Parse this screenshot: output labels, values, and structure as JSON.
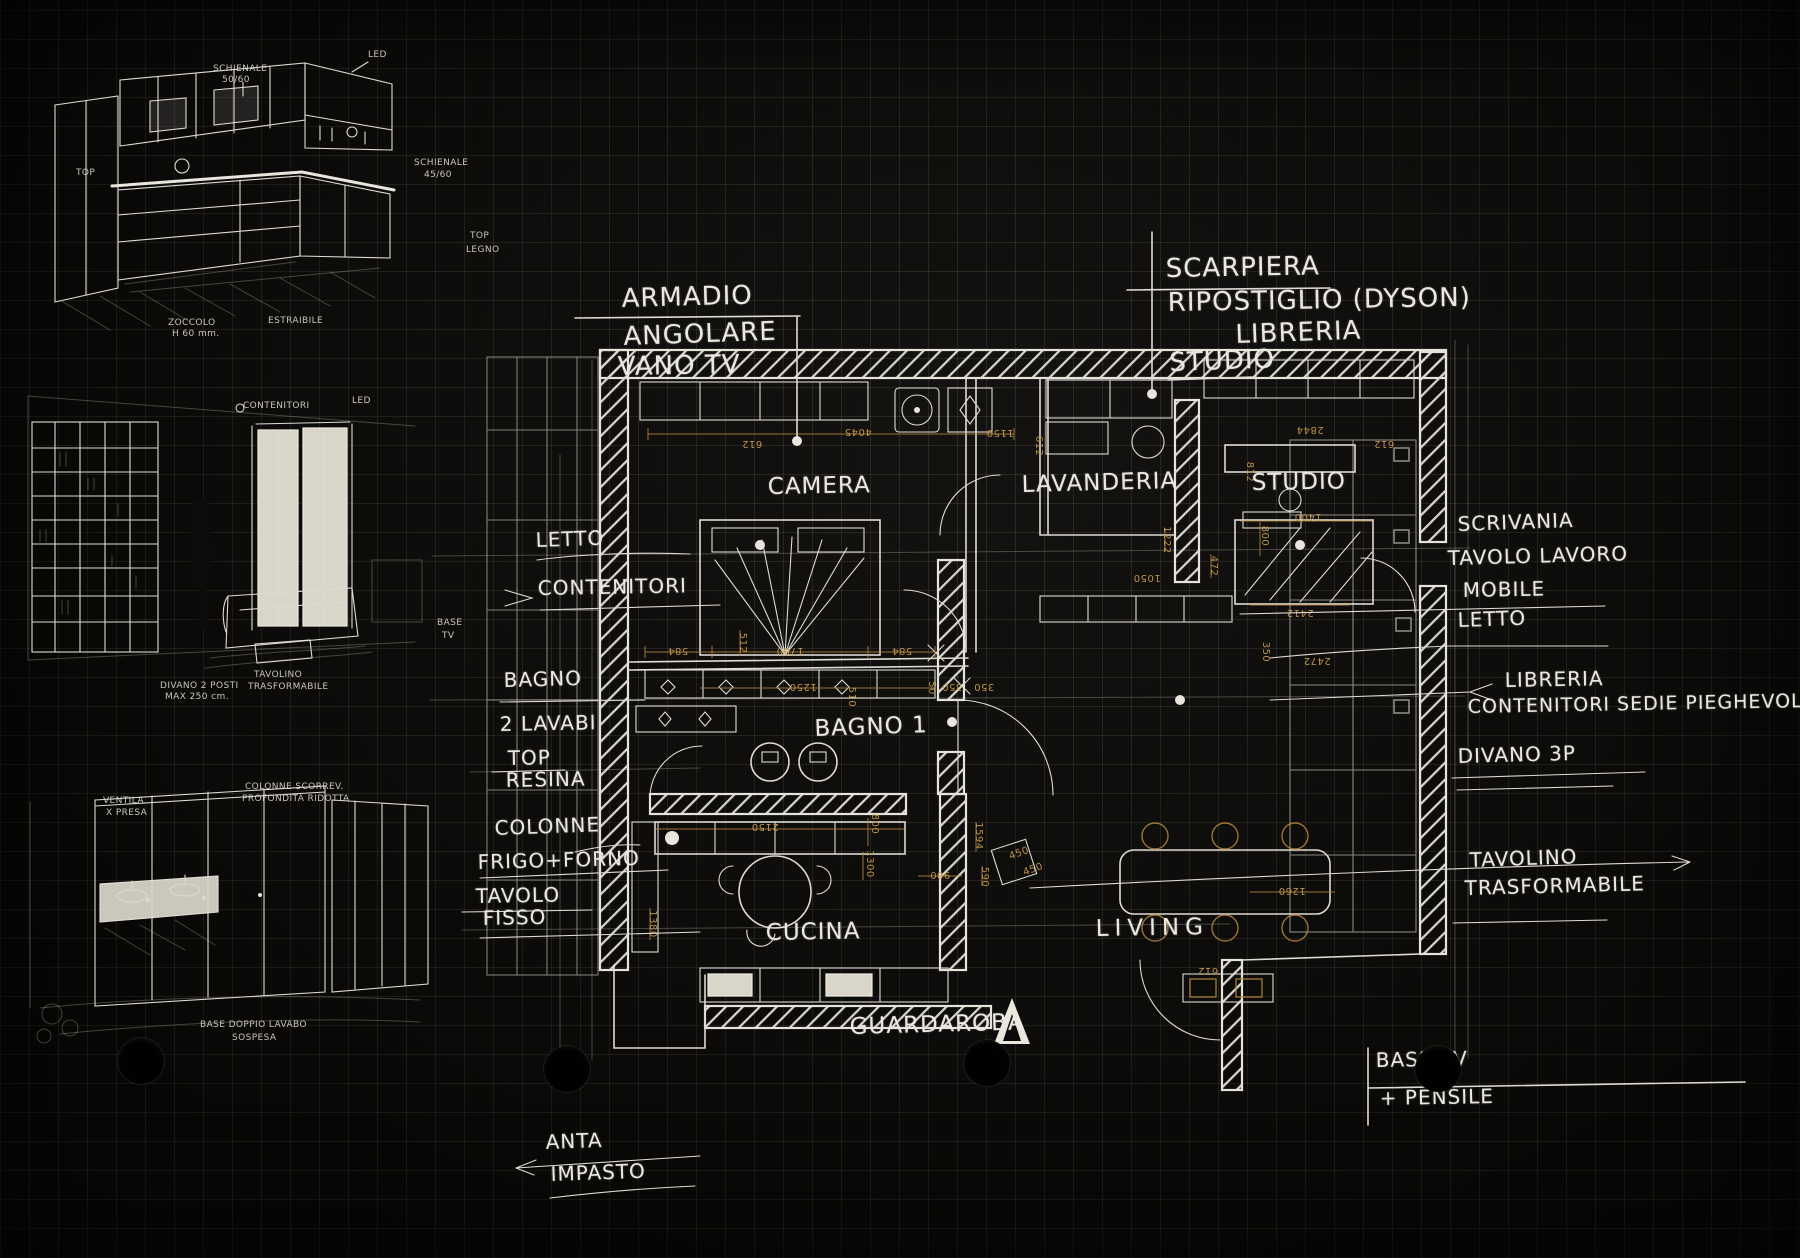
{
  "colors": {
    "paper": "#0b0a08",
    "grid": "#6e695f",
    "ink": "#eae8e0",
    "dimension": "#c2954a"
  },
  "callout_armadio": {
    "l1": "ARMADIO",
    "l2": "ANGOLARE",
    "l3": "VANO TV"
  },
  "callout_scarpiera": {
    "l1": "SCARPIERA",
    "l2": "RIPOSTIGLIO (DYSON)",
    "l3": "LIBRERIA",
    "l4": "STUDIO"
  },
  "rooms": {
    "camera": "CAMERA",
    "lavanderia": "LAVANDERIA",
    "studio": "STUDIO",
    "bagno1": "BAGNO 1",
    "cucina": "CUCINA",
    "living": "LIVING",
    "guardaroba": "GUARDAROBA"
  },
  "notes_left": {
    "letto": "LETTO",
    "contenitori": "CONTENITORI",
    "bagno": "BAGNO",
    "lavabi": "2 LAVABI",
    "top": "TOP",
    "resina": "RESINA",
    "colonne": "COLONNE",
    "frigo_forno": "FRIGO+FORNO",
    "tavolo": "TAVOLO",
    "fisso": "FISSO",
    "anta": "ANTA",
    "impasto": "IMPASTO"
  },
  "notes_right": {
    "scrivania": "SCRIVANIA",
    "tavolo_lavoro": "TAVOLO LAVORO",
    "mobile": "MOBILE",
    "letto": "LETTO",
    "libreria": "LIBRERIA",
    "contenitori_sedie": "CONTENITORI SEDIE PIEGHEVOLI",
    "divano": "DIVANO 3P",
    "tavolino": "TAVOLINO",
    "trasformabile": "TRASFORMABILE",
    "base_tv": "BASE TV",
    "pensile": "+ PENSILE"
  },
  "sketch_kitchen": {
    "schienale": "SCHIENALE",
    "schienale_dim": "50/60",
    "led": "LED",
    "top": "TOP",
    "schienale2": "SCHIENALE",
    "schienale2_dim": "45/60",
    "top_legno_a": "TOP",
    "top_legno_b": "LEGNO",
    "zoccolo": "ZOCCOLO",
    "zoccolo_dim": "H 60 mm.",
    "estraibile": "ESTRAIBILE"
  },
  "sketch_living": {
    "contenitori": "CONTENITORI",
    "led": "LED",
    "base": "BASE",
    "tv": "TV",
    "divano_a": "DIVANO 2 POSTI",
    "divano_b": "MAX 250 cm.",
    "tavolino_a": "TAVOLINO",
    "tavolino_b": "TRASFORMABILE"
  },
  "sketch_bath": {
    "ventola_a": "VENTILA",
    "ventola_b": "X PRESA",
    "colonne_a": "COLONNE SCORREV.",
    "colonne_b": "PROFONDITÀ RIDOTTA",
    "base_a": "BASE DOPPIO LAVABO",
    "base_b": "SOSPESA"
  },
  "plan": {
    "dims": [
      "612",
      "4045",
      "1150",
      "612",
      "2844",
      "612",
      "1400",
      "800",
      "2412",
      "350",
      "2472",
      "1222",
      "472",
      "1050",
      "512",
      "584",
      "1700",
      "584",
      "1250",
      "350",
      "350",
      "50",
      "510",
      "2150",
      "800",
      "1300",
      "1594",
      "590",
      "450",
      "450",
      "1260",
      "612",
      "1380",
      "900",
      "812"
    ]
  }
}
